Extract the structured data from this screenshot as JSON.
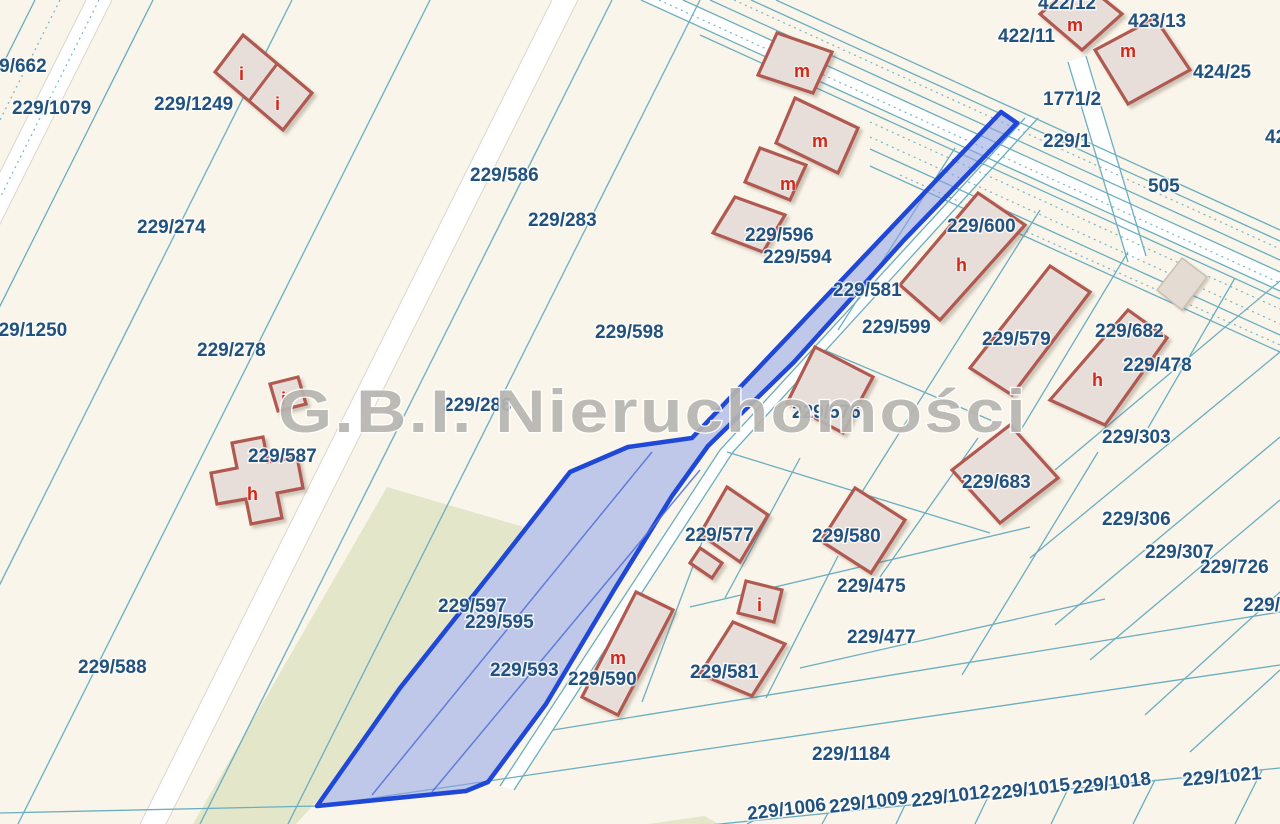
{
  "watermark": {
    "text": "G.B.I. Nieruchomości"
  },
  "colors": {
    "background": "#faf5ea",
    "boundary_line": "#6aaec0",
    "parcel_label": "#21527f",
    "building_outline": "#b05950",
    "building_fill": "#e8ded9",
    "building_letter": "#d2281a",
    "highlight_fill": "#8fa2e8",
    "highlight_border": "#1f48d8",
    "greenery": "#e3e6c8",
    "watermark": "#b7b5b0",
    "road_white": "#ffffff"
  },
  "highlighted_parcels": [
    "229/597",
    "229/595",
    "229/593"
  ],
  "parcel_labels": [
    {
      "text": "229/662",
      "x": -22,
      "y": 72
    },
    {
      "text": "229/1079",
      "x": 12,
      "y": 114
    },
    {
      "text": "229/1249",
      "x": 154,
      "y": 110
    },
    {
      "text": "229/274",
      "x": 137,
      "y": 233
    },
    {
      "text": "229/586",
      "x": 470,
      "y": 181
    },
    {
      "text": "229/283",
      "x": 528,
      "y": 226
    },
    {
      "text": "229/1250",
      "x": -12,
      "y": 336
    },
    {
      "text": "229/278",
      "x": 197,
      "y": 356
    },
    {
      "text": "229/598",
      "x": 595,
      "y": 338
    },
    {
      "text": "229/286",
      "x": 443,
      "y": 411
    },
    {
      "text": "229/587",
      "x": 248,
      "y": 462
    },
    {
      "text": "229/588",
      "x": 78,
      "y": 673
    },
    {
      "text": "229/596",
      "x": 745,
      "y": 241
    },
    {
      "text": "229/594",
      "x": 763,
      "y": 263
    },
    {
      "text": "229/581",
      "x": 833,
      "y": 296
    },
    {
      "text": "229/599",
      "x": 862,
      "y": 333
    },
    {
      "text": "229/600",
      "x": 947,
      "y": 232
    },
    {
      "text": "229/579",
      "x": 982,
      "y": 345
    },
    {
      "text": "229/682",
      "x": 1095,
      "y": 337
    },
    {
      "text": "229/478",
      "x": 1123,
      "y": 371
    },
    {
      "text": "229/303",
      "x": 1102,
      "y": 443
    },
    {
      "text": "229/683",
      "x": 962,
      "y": 488
    },
    {
      "text": "229/306",
      "x": 1102,
      "y": 525
    },
    {
      "text": "229/307",
      "x": 1145,
      "y": 558
    },
    {
      "text": "229/726",
      "x": 1200,
      "y": 573
    },
    {
      "text": "229/7",
      "x": 1243,
      "y": 611
    },
    {
      "text": "229/576",
      "x": 792,
      "y": 418
    },
    {
      "text": "229/577",
      "x": 685,
      "y": 541
    },
    {
      "text": "229/580",
      "x": 812,
      "y": 542
    },
    {
      "text": "229/475",
      "x": 837,
      "y": 592
    },
    {
      "text": "229/477",
      "x": 847,
      "y": 643
    },
    {
      "text": "229/597",
      "x": 438,
      "y": 612
    },
    {
      "text": "229/595",
      "x": 465,
      "y": 628
    },
    {
      "text": "229/593",
      "x": 490,
      "y": 676
    },
    {
      "text": "229/590",
      "x": 568,
      "y": 685
    },
    {
      "text": "229/581",
      "x": 690,
      "y": 678
    },
    {
      "text": "422/11",
      "x": 998,
      "y": 42
    },
    {
      "text": "422/12",
      "x": 1038,
      "y": 9
    },
    {
      "text": "423/13",
      "x": 1128,
      "y": 27
    },
    {
      "text": "424/25",
      "x": 1193,
      "y": 78
    },
    {
      "text": "1771/2",
      "x": 1043,
      "y": 105
    },
    {
      "text": "229/1",
      "x": 1043,
      "y": 147
    },
    {
      "text": "505",
      "x": 1148,
      "y": 192
    },
    {
      "text": "42",
      "x": 1265,
      "y": 143
    },
    {
      "text": "229/1184",
      "x": 812,
      "y": 760
    },
    {
      "text": "229/1006",
      "x": 748,
      "y": 820,
      "rot": -7
    },
    {
      "text": "229/1009",
      "x": 830,
      "y": 813,
      "rot": -7
    },
    {
      "text": "229/1012",
      "x": 912,
      "y": 807,
      "rot": -7
    },
    {
      "text": "229/1015",
      "x": 992,
      "y": 800,
      "rot": -7
    },
    {
      "text": "229/1018",
      "x": 1073,
      "y": 794,
      "rot": -7
    },
    {
      "text": "229/1021",
      "x": 1183,
      "y": 786,
      "rot": -5
    }
  ],
  "building_marks": [
    {
      "text": "i",
      "x": 239,
      "y": 80
    },
    {
      "text": "i",
      "x": 275,
      "y": 110
    },
    {
      "text": "m",
      "x": 794,
      "y": 77
    },
    {
      "text": "m",
      "x": 812,
      "y": 147
    },
    {
      "text": "m",
      "x": 780,
      "y": 190
    },
    {
      "text": "m",
      "x": 1067,
      "y": 31
    },
    {
      "text": "m",
      "x": 1120,
      "y": 57
    },
    {
      "text": "h",
      "x": 956,
      "y": 271
    },
    {
      "text": "h",
      "x": 1092,
      "y": 386
    },
    {
      "text": "h",
      "x": 247,
      "y": 500
    },
    {
      "text": "i",
      "x": 281,
      "y": 405
    },
    {
      "text": "m",
      "x": 610,
      "y": 664
    },
    {
      "text": "i",
      "x": 757,
      "y": 611
    }
  ]
}
